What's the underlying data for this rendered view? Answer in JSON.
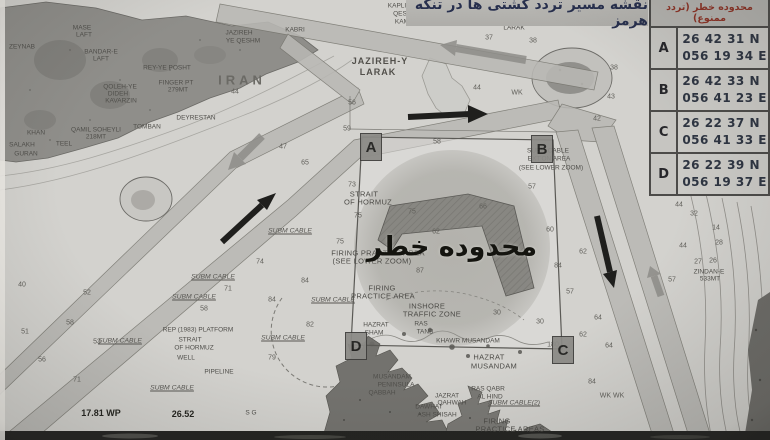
{
  "title": {
    "text": "نقشه مسیر تردد کشتی ها در تنگه هرمز"
  },
  "danger_table": {
    "header": "محدوده خطر (تردد ممنوع)",
    "rows": [
      {
        "point": "A",
        "lat": "26 42 31 N",
        "lon": "056 19 34 E"
      },
      {
        "point": "B",
        "lat": "26 42 33 N",
        "lon": "056 41 23 E"
      },
      {
        "point": "C",
        "lat": "26 22 37 N",
        "lon": "056 41 33 E"
      },
      {
        "point": "D",
        "lat": "26 22 39 N",
        "lon": "056 19 37 E"
      }
    ]
  },
  "map": {
    "danger_zone_label": "محدوده خطر",
    "colors": {
      "sea": "#d3d2ce",
      "land": "#8f8e8a",
      "lane": "#b9b8b4",
      "danger_zone": "#9b9a96",
      "ink": "#4a4a46",
      "title_text": "#272f4d",
      "table_header_text": "#8c3326"
    },
    "corner_markers": [
      {
        "label": "A",
        "x": 371,
        "y": 147
      },
      {
        "label": "B",
        "x": 542,
        "y": 149
      },
      {
        "label": "C",
        "x": 563,
        "y": 350
      },
      {
        "label": "D",
        "x": 356,
        "y": 346
      }
    ],
    "place_labels": [
      {
        "text": "KAPLI",
        "x": 397,
        "y": 6,
        "cls": "tiny"
      },
      {
        "text": "QESHM",
        "x": 405,
        "y": 14,
        "cls": "tiny"
      },
      {
        "text": "KAMRLI",
        "x": 407,
        "y": 22,
        "cls": "tiny"
      },
      {
        "text": "MASE",
        "x": 82,
        "y": 28,
        "cls": "tiny"
      },
      {
        "text": "LAFT",
        "x": 84,
        "y": 35,
        "cls": "tiny"
      },
      {
        "text": "BANDAR-E",
        "x": 101,
        "y": 52,
        "cls": "tiny"
      },
      {
        "text": "LAFT",
        "x": 101,
        "y": 59,
        "cls": "tiny"
      },
      {
        "text": "ZEYNAB",
        "x": 22,
        "y": 47,
        "cls": "tiny"
      },
      {
        "text": "JAZIREH",
        "x": 239,
        "y": 33,
        "cls": "tiny"
      },
      {
        "text": "YE QESHM",
        "x": 243,
        "y": 41,
        "cls": "tiny"
      },
      {
        "text": "KABRI",
        "x": 295,
        "y": 30,
        "cls": "tiny"
      },
      {
        "text": "IRAN",
        "x": 242,
        "y": 80,
        "cls": "big"
      },
      {
        "text": "REY-YE POSHT",
        "x": 167,
        "y": 68,
        "cls": "tiny"
      },
      {
        "text": "FINGER PT",
        "x": 176,
        "y": 83,
        "cls": "tiny"
      },
      {
        "text": "279MT",
        "x": 178,
        "y": 90,
        "cls": "tiny"
      },
      {
        "text": "QOLEH-YE",
        "x": 120,
        "y": 87,
        "cls": "tiny"
      },
      {
        "text": "DIDEH",
        "x": 118,
        "y": 94,
        "cls": "tiny"
      },
      {
        "text": "KAVARZIN",
        "x": 121,
        "y": 101,
        "cls": "tiny"
      },
      {
        "text": "DEYRESTAN",
        "x": 196,
        "y": 118,
        "cls": "tiny"
      },
      {
        "text": "QAMIL SOHEYLI",
        "x": 96,
        "y": 130,
        "cls": "tiny"
      },
      {
        "text": "218MT",
        "x": 96,
        "y": 137,
        "cls": "tiny"
      },
      {
        "text": "TOMBAN",
        "x": 147,
        "y": 127,
        "cls": "tiny"
      },
      {
        "text": "KHAN",
        "x": 36,
        "y": 133,
        "cls": "tiny"
      },
      {
        "text": "SALAKH",
        "x": 22,
        "y": 145,
        "cls": "tiny"
      },
      {
        "text": "TEEL",
        "x": 64,
        "y": 144,
        "cls": "tiny"
      },
      {
        "text": "GURAN",
        "x": 26,
        "y": 154,
        "cls": "tiny"
      },
      {
        "text": "JAZIREH-Y",
        "x": 380,
        "y": 61,
        "cls": "med"
      },
      {
        "text": "LARAK",
        "x": 378,
        "y": 72,
        "cls": "med"
      },
      {
        "text": "JAZIREH-YE",
        "x": 514,
        "y": 20,
        "cls": "tiny"
      },
      {
        "text": "LARAK",
        "x": 514,
        "y": 28,
        "cls": "tiny"
      },
      {
        "text": "STRAIT",
        "x": 364,
        "y": 194,
        "cls": "place"
      },
      {
        "text": "OF HORMUZ",
        "x": 368,
        "y": 202,
        "cls": "place"
      },
      {
        "text": "SUBM CABLE",
        "x": 290,
        "y": 231,
        "cls": "cable"
      },
      {
        "text": "SUBM CABLE",
        "x": 213,
        "y": 277,
        "cls": "cable"
      },
      {
        "text": "SUBM CABLE",
        "x": 194,
        "y": 297,
        "cls": "cable"
      },
      {
        "text": "SUBM CABLE",
        "x": 333,
        "y": 300,
        "cls": "cable"
      },
      {
        "text": "SUBM CABLE",
        "x": 283,
        "y": 338,
        "cls": "cable"
      },
      {
        "text": "SUBM CABLE",
        "x": 120,
        "y": 341,
        "cls": "cable"
      },
      {
        "text": "SUBM CABLE",
        "x": 172,
        "y": 388,
        "cls": "cable"
      },
      {
        "text": "SUBM CABLE(2)",
        "x": 514,
        "y": 403,
        "cls": "cable"
      },
      {
        "text": "REP (1983) PLATFORM",
        "x": 198,
        "y": 330,
        "cls": "tiny"
      },
      {
        "text": "STRAIT",
        "x": 190,
        "y": 340,
        "cls": "tiny"
      },
      {
        "text": "OF HORMUZ",
        "x": 194,
        "y": 348,
        "cls": "tiny"
      },
      {
        "text": "WELL",
        "x": 186,
        "y": 358,
        "cls": "tiny"
      },
      {
        "text": "PIPELINE",
        "x": 219,
        "y": 372,
        "cls": "tiny"
      },
      {
        "text": "FIRING PRACTICE AREA",
        "x": 378,
        "y": 253,
        "cls": "place"
      },
      {
        "text": "(SEE LOWER ZOOM)",
        "x": 372,
        "y": 261,
        "cls": "place"
      },
      {
        "text": "FIRING",
        "x": 382,
        "y": 288,
        "cls": "place"
      },
      {
        "text": "PRACTICE AREA",
        "x": 383,
        "y": 296,
        "cls": "place"
      },
      {
        "text": "INSHORE",
        "x": 427,
        "y": 306,
        "cls": "place"
      },
      {
        "text": "TRAFFIC ZONE",
        "x": 432,
        "y": 314,
        "cls": "place"
      },
      {
        "text": "RAS",
        "x": 421,
        "y": 324,
        "cls": "tiny"
      },
      {
        "text": "TANB",
        "x": 425,
        "y": 332,
        "cls": "tiny"
      },
      {
        "text": "KHAWR MUSANDAM",
        "x": 468,
        "y": 341,
        "cls": "tiny"
      },
      {
        "text": "HAZRAT",
        "x": 376,
        "y": 325,
        "cls": "tiny"
      },
      {
        "text": "SHAM",
        "x": 374,
        "y": 333,
        "cls": "tiny"
      },
      {
        "text": "HAZRAT",
        "x": 489,
        "y": 357,
        "cls": "place"
      },
      {
        "text": "MUSANDAM",
        "x": 494,
        "y": 366,
        "cls": "place"
      },
      {
        "text": "MUSANDAM",
        "x": 392,
        "y": 377,
        "cls": "tiny"
      },
      {
        "text": "PENINSULA",
        "x": 396,
        "y": 385,
        "cls": "tiny"
      },
      {
        "text": "QABBAH",
        "x": 382,
        "y": 393,
        "cls": "tiny"
      },
      {
        "text": "JAZRAT",
        "x": 447,
        "y": 396,
        "cls": "tiny"
      },
      {
        "text": "QAHWAH",
        "x": 452,
        "y": 403,
        "cls": "tiny"
      },
      {
        "text": "DAWHAT",
        "x": 429,
        "y": 407,
        "cls": "tiny"
      },
      {
        "text": "ASH SHISAH",
        "x": 437,
        "y": 415,
        "cls": "tiny"
      },
      {
        "text": "RAS QABR",
        "x": 488,
        "y": 389,
        "cls": "tiny"
      },
      {
        "text": "AL HIND",
        "x": 490,
        "y": 397,
        "cls": "tiny"
      },
      {
        "text": "FIRING",
        "x": 497,
        "y": 421,
        "cls": "place"
      },
      {
        "text": "PRACTICE AREAS",
        "x": 510,
        "y": 429,
        "cls": "place"
      },
      {
        "text": "SUBM CABLE",
        "x": 548,
        "y": 151,
        "cls": "tiny"
      },
      {
        "text": "EXT'ON AREA",
        "x": 549,
        "y": 159,
        "cls": "tiny"
      },
      {
        "text": "(SEE LOWER ZOOM)",
        "x": 551,
        "y": 168,
        "cls": "tiny"
      },
      {
        "text": "ZINDAN-E",
        "x": 709,
        "y": 272,
        "cls": "tiny"
      },
      {
        "text": "533MT",
        "x": 710,
        "y": 279,
        "cls": "tiny"
      },
      {
        "text": "S G",
        "x": 251,
        "y": 413,
        "cls": "tiny"
      },
      {
        "text": "17.81 WP",
        "x": 101,
        "y": 413,
        "cls": "hand"
      },
      {
        "text": "26.52",
        "x": 183,
        "y": 414,
        "cls": "hand"
      }
    ],
    "depth_marks": [
      {
        "t": "37",
        "x": 489,
        "y": 38
      },
      {
        "t": "38",
        "x": 533,
        "y": 41
      },
      {
        "t": "38",
        "x": 614,
        "y": 68
      },
      {
        "t": "43",
        "x": 611,
        "y": 97
      },
      {
        "t": "42",
        "x": 597,
        "y": 119
      },
      {
        "t": "44",
        "x": 235,
        "y": 92
      },
      {
        "t": "44",
        "x": 477,
        "y": 88
      },
      {
        "t": "WK",
        "x": 517,
        "y": 93
      },
      {
        "t": "56",
        "x": 352,
        "y": 103
      },
      {
        "t": "59",
        "x": 347,
        "y": 129
      },
      {
        "t": "58",
        "x": 437,
        "y": 142
      },
      {
        "t": "65",
        "x": 305,
        "y": 163
      },
      {
        "t": "47",
        "x": 283,
        "y": 147
      },
      {
        "t": "73",
        "x": 352,
        "y": 185
      },
      {
        "t": "75",
        "x": 358,
        "y": 216
      },
      {
        "t": "75",
        "x": 412,
        "y": 212
      },
      {
        "t": "66",
        "x": 483,
        "y": 207
      },
      {
        "t": "62",
        "x": 436,
        "y": 232
      },
      {
        "t": "57",
        "x": 532,
        "y": 187
      },
      {
        "t": "60",
        "x": 550,
        "y": 230
      },
      {
        "t": "62",
        "x": 583,
        "y": 252
      },
      {
        "t": "57",
        "x": 570,
        "y": 292
      },
      {
        "t": "74",
        "x": 260,
        "y": 262
      },
      {
        "t": "75",
        "x": 340,
        "y": 242
      },
      {
        "t": "84",
        "x": 305,
        "y": 281
      },
      {
        "t": "71",
        "x": 228,
        "y": 289
      },
      {
        "t": "84",
        "x": 272,
        "y": 300
      },
      {
        "t": "58",
        "x": 204,
        "y": 309
      },
      {
        "t": "82",
        "x": 310,
        "y": 325
      },
      {
        "t": "79",
        "x": 272,
        "y": 358
      },
      {
        "t": "40",
        "x": 22,
        "y": 285
      },
      {
        "t": "52",
        "x": 87,
        "y": 293
      },
      {
        "t": "51",
        "x": 25,
        "y": 332
      },
      {
        "t": "58",
        "x": 70,
        "y": 323
      },
      {
        "t": "53",
        "x": 97,
        "y": 342
      },
      {
        "t": "56",
        "x": 42,
        "y": 360
      },
      {
        "t": "71",
        "x": 77,
        "y": 380
      },
      {
        "t": "64",
        "x": 598,
        "y": 318
      },
      {
        "t": "64",
        "x": 609,
        "y": 346
      },
      {
        "t": "62",
        "x": 583,
        "y": 335
      },
      {
        "t": "84",
        "x": 592,
        "y": 382
      },
      {
        "t": "WK WK",
        "x": 612,
        "y": 396
      },
      {
        "t": "44",
        "x": 679,
        "y": 205
      },
      {
        "t": "32",
        "x": 694,
        "y": 214
      },
      {
        "t": "44",
        "x": 683,
        "y": 246
      },
      {
        "t": "27",
        "x": 698,
        "y": 262
      },
      {
        "t": "57",
        "x": 672,
        "y": 280
      },
      {
        "t": "14",
        "x": 716,
        "y": 228
      },
      {
        "t": "28",
        "x": 719,
        "y": 243
      },
      {
        "t": "26",
        "x": 713,
        "y": 261
      },
      {
        "t": "30",
        "x": 497,
        "y": 313
      },
      {
        "t": "30",
        "x": 540,
        "y": 322
      },
      {
        "t": "180",
        "x": 553,
        "y": 345
      },
      {
        "t": "87",
        "x": 420,
        "y": 271
      },
      {
        "t": "84",
        "x": 558,
        "y": 266
      }
    ]
  }
}
